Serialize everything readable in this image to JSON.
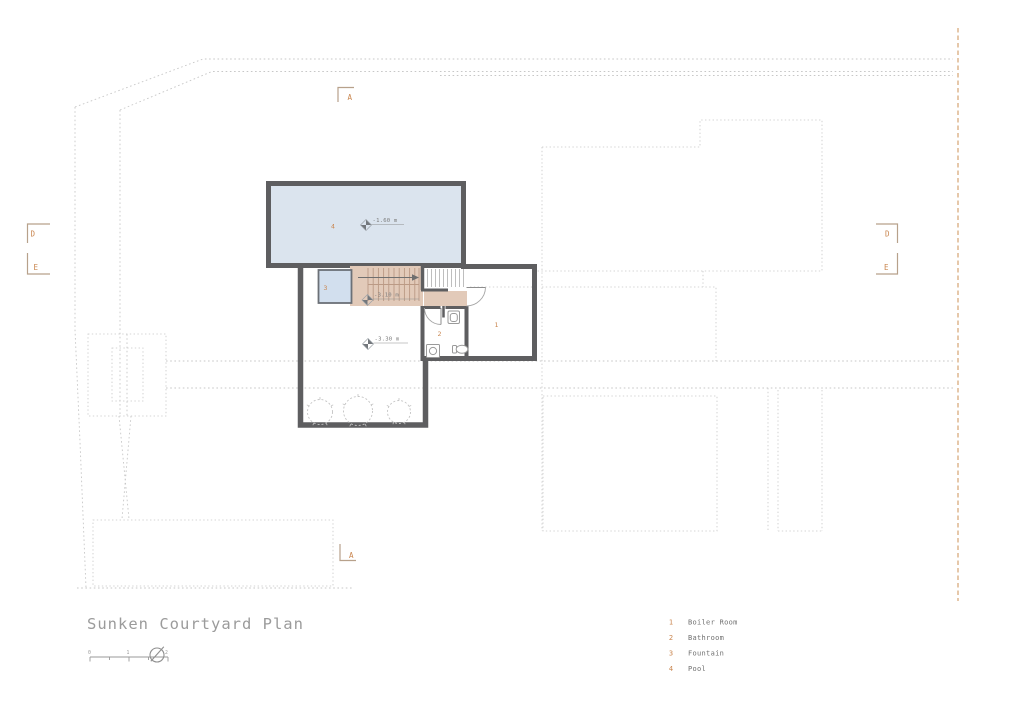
{
  "title": "Sunken Courtyard Plan",
  "legend": {
    "items": [
      {
        "num": "1",
        "label": "Boiler Room"
      },
      {
        "num": "2",
        "label": "Bathroom"
      },
      {
        "num": "3",
        "label": "Fountain"
      },
      {
        "num": "4",
        "label": "Pool"
      }
    ]
  },
  "room_labels": {
    "boiler": "1",
    "bathroom": "2",
    "fountain": "3",
    "pool": "4"
  },
  "annotations": {
    "pool_level": "-1.60 m",
    "stair_level": "-3.10 m",
    "courtyard_level": "-3.30 m"
  },
  "section_markers": {
    "top_a": "A",
    "bottom_a": "A",
    "left_d": "D",
    "left_e": "E",
    "right_d": "D",
    "right_e": "E"
  },
  "scale_bar": {
    "ticks": [
      "0",
      "1",
      "2"
    ]
  },
  "icons": {
    "north": "north-arrow-icon",
    "level": "spot-level-marker-icon"
  },
  "colors": {
    "wall": "#5e5e60",
    "pool_fill": "#dbe4ee",
    "fountain_fill": "#d2dfee",
    "stair_fill": "#e2cab9",
    "stair_tread": "#bb9a85",
    "accent_orange": "#c9854e",
    "bracket_tan": "#b7a18b",
    "cut_line_orange": "#d8ab7d",
    "dotted_gray": "#c7c7c7"
  }
}
